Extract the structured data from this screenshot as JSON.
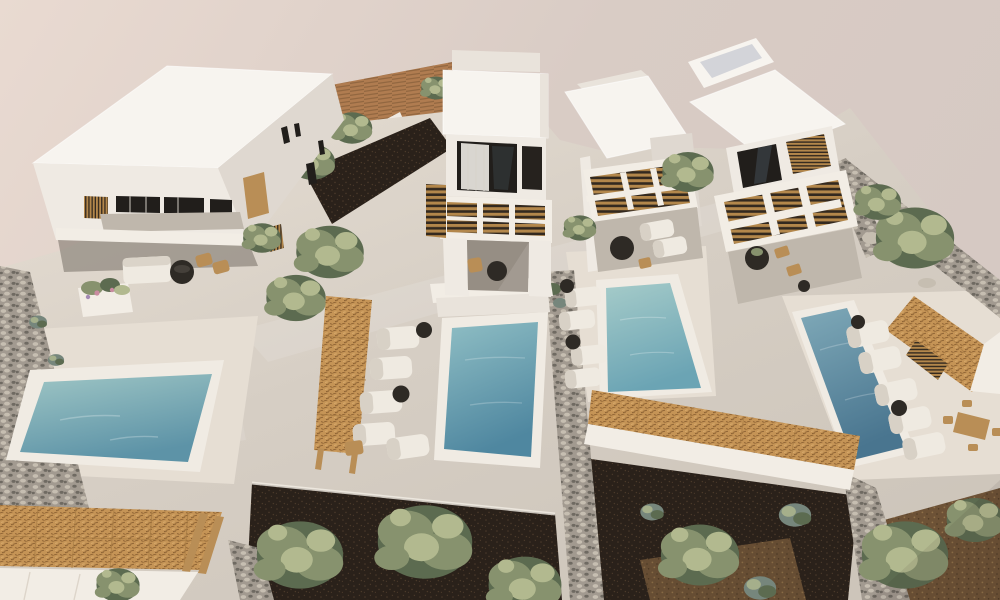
{
  "meta": {
    "type": "architectural-3d-rendering",
    "view": "aerial"
  },
  "scene": {
    "description": "Aerial 3D architectural rendering of a complex of four white Cycladic-style villas with flat roofs, wooden-slat pergolas, straw-roof shade structures, four turquoise private pools with white sun loungers and dark parasols, olive trees, dark planted garden beds, stone walls and a terracotta field behind.",
    "villa_count": 4,
    "pool_count": 4,
    "objects": [
      "two-storey-villa-left",
      "two-storey-villa-center",
      "villa-center-right",
      "two-storey-villa-right",
      "square-pool-left",
      "rect-pool-center",
      "rect-pool-center-right",
      "rect-pool-right",
      "straw-pergola-walkways",
      "wood-slat-pergolas",
      "olive-trees",
      "stone-walls",
      "sun-loungers",
      "parasols",
      "fire-tables",
      "outdoor-dining-set",
      "planters",
      "terracotta-field"
    ]
  },
  "palette": {
    "sky": "#d9ccc5",
    "sky-light": "#e9dad1",
    "roof": "#f7f4ef",
    "roof-shade": "#e9e3db",
    "wall": "#efeae3",
    "wall-shade": "#dfd8d0",
    "wall-dark": "#cfc8c0",
    "shade-blue": "#c7c9d2",
    "deck": "#d6cec4",
    "deck-bright": "#e6ded3",
    "deck-shade": "#bfb7ac",
    "pool-rim": "#f0ebe3",
    "water-teal-light": "#9fc6c5",
    "water-teal-deep": "#5d93a7",
    "water2-light": "#8fbec4",
    "water2-deep": "#4f87a0",
    "water3-light": "#a5cbc9",
    "water3-deep": "#6ba4b4",
    "water4-light": "#7fa9b8",
    "water4-deep": "#49758f",
    "straw": "#c59456",
    "straw-dark": "#8c6132",
    "straw-line": "#a87c44",
    "wood-tan": "#b98e56",
    "wood-slat": "#b3874b",
    "wood-dark": "#33291f",
    "field": "#b07c50",
    "field-line": "#926740",
    "soil": "#2a211a",
    "soil-dot": "#4a392a",
    "gravel": "#6d5236",
    "gravel-dot": "#8f7148",
    "stone": "#a29a90",
    "stone-light": "#c6beb1",
    "stone-dark": "#6f6a62",
    "green-dark": "#5c6b50",
    "green": "#87926e",
    "green-light": "#b2b98f",
    "green-blue": "#76867c",
    "white-soft": "#f2ede5",
    "dark": "#2b2723",
    "glass": "#211e1b",
    "curtain": "#e9e6df",
    "furniture-white": "#efeae1",
    "furniture-dark": "#2e2a25",
    "flower-pink": "#c98ba0"
  }
}
